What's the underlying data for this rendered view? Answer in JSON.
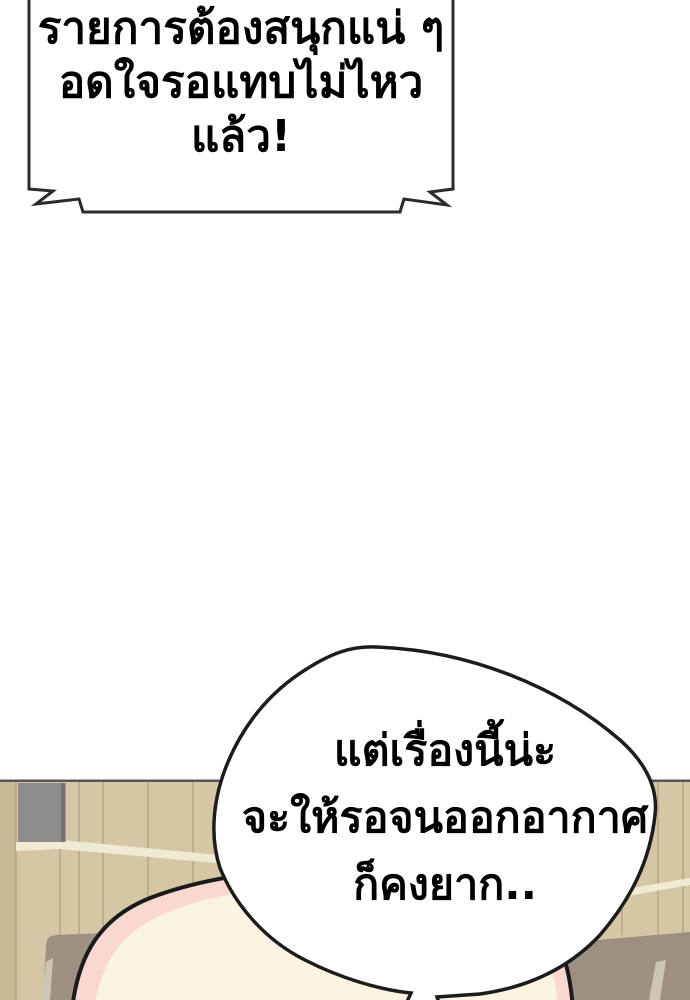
{
  "panel": {
    "type": "webtoon-comic-panel"
  },
  "bubble_top": {
    "shape": "torn-banner-shout-bubble",
    "line1": "รายการต้องสนุกแน่ ๆ",
    "line2": "อดใจรอแทบไม่ไหวแล้ว!"
  },
  "bubble_bottom": {
    "shape": "round-blob-bubble-with-tail",
    "line1": "แต่เรื่องนี้น่ะ",
    "line2": "จะให้รอจนออกอากาศ",
    "line3": "ก็คงยาก.."
  },
  "colors": {
    "background": "#ffffff",
    "outline": "#222222",
    "bubble_fill": "#ffffff",
    "text": "#000000",
    "wood": "#d5c6a6",
    "wood_dark_plank": "#c8b893",
    "wood_grain": "#a3906f",
    "wood_highlight_strip": "#f0e9d4",
    "wall_top_line": "#575757",
    "gray_block": "#8d8d8d",
    "gray_block_edge": "#747474",
    "furniture_brown": "#9d9083",
    "furniture_highlight": "#cdc5b5",
    "head_skin": "#fcf4e2",
    "head_pink_rim": "#f8d8cf"
  }
}
